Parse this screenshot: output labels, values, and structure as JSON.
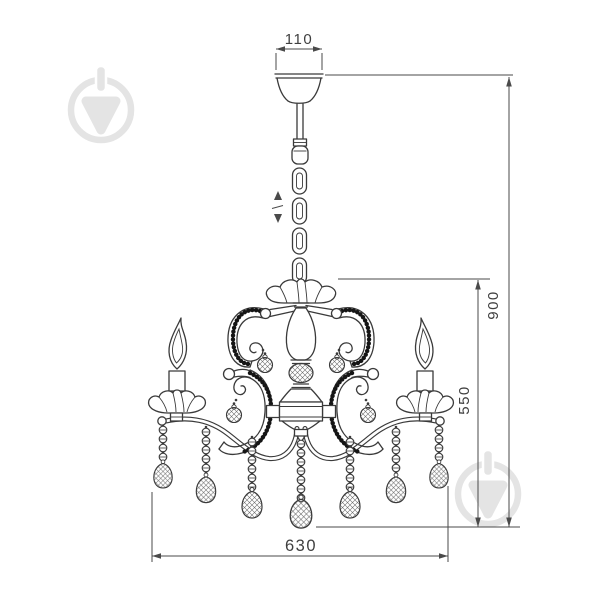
{
  "dimensions": {
    "canopy_width_mm": "110",
    "overall_height_mm": "900",
    "body_height_mm": "550",
    "overall_width_mm": "630"
  },
  "icons": {
    "height_adjust": "up-down-arrows-icon",
    "watermark": "marketplace-logo-icon"
  },
  "colors": {
    "ink": "#3a3a3a",
    "bead": "#151515",
    "watermark": "#e4e4e4",
    "background": "#ffffff"
  }
}
